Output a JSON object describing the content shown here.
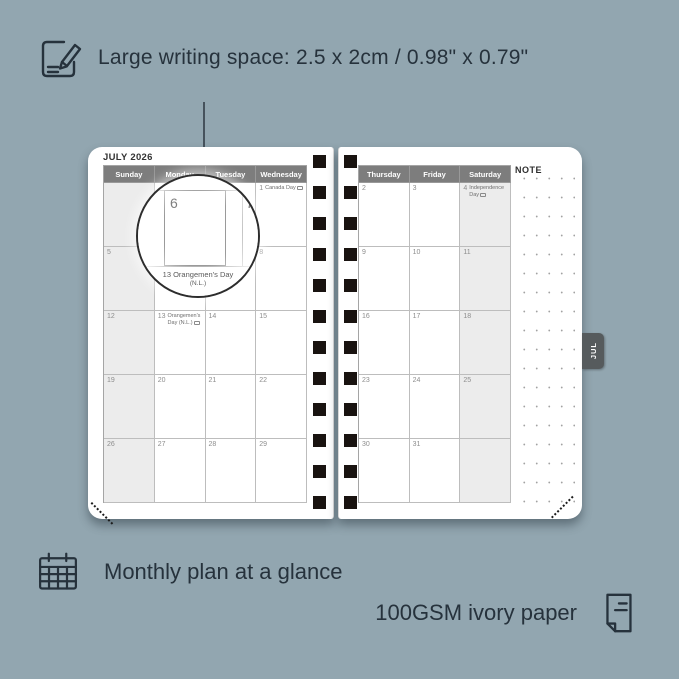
{
  "colors": {
    "background": "#92a6b0",
    "ink": "#26323c",
    "page": "#ffffff",
    "header_bg": "#7d7d7d",
    "header_text": "#ffffff",
    "weekend_fill": "#ececec",
    "grid_line": "#bdbdbd",
    "day_number": "#8d8d8d",
    "tab_bg": "#565b5d",
    "spiral_hole": "#191310"
  },
  "callouts": {
    "writing_space": {
      "label": "Large writing space: 2.5 x 2cm / 0.98\" x 0.79\"",
      "icon": "pencil-note-icon"
    },
    "monthly_plan": {
      "label": "Monthly plan at a glance",
      "icon": "calendar-grid-icon"
    },
    "paper": {
      "label": "100GSM ivory paper",
      "icon": "paper-sheet-icon"
    }
  },
  "planner": {
    "month_title": "JULY 2026",
    "tab_label": "JUL",
    "left_page": {
      "day_headers": [
        "Sunday",
        "Monday",
        "Tuesday",
        "Wednesday"
      ],
      "weekend_column": 0,
      "weeks": [
        [
          {
            "day": ""
          },
          {
            "day": ""
          },
          {
            "day": ""
          },
          {
            "day": "1",
            "label": "Canada Day",
            "badge": true
          }
        ],
        [
          {
            "day": "5"
          },
          {
            "day": "6"
          },
          {
            "day": "7"
          },
          {
            "day": "8"
          }
        ],
        [
          {
            "day": "12"
          },
          {
            "day": "13",
            "label": "Orangemen's Day (N.L.)",
            "badge": true
          },
          {
            "day": "14"
          },
          {
            "day": "15"
          }
        ],
        [
          {
            "day": "19"
          },
          {
            "day": "20"
          },
          {
            "day": "21"
          },
          {
            "day": "22"
          }
        ],
        [
          {
            "day": "26"
          },
          {
            "day": "27"
          },
          {
            "day": "28"
          },
          {
            "day": "29"
          }
        ]
      ]
    },
    "right_page": {
      "day_headers": [
        "Thursday",
        "Friday",
        "Saturday"
      ],
      "weekend_column": 2,
      "note_label": "NOTE",
      "weeks": [
        [
          {
            "day": "2"
          },
          {
            "day": "3"
          },
          {
            "day": "4",
            "label": "Independence Day",
            "badge": true
          }
        ],
        [
          {
            "day": "9"
          },
          {
            "day": "10"
          },
          {
            "day": "11"
          }
        ],
        [
          {
            "day": "16"
          },
          {
            "day": "17"
          },
          {
            "day": "18"
          }
        ],
        [
          {
            "day": "23"
          },
          {
            "day": "24"
          },
          {
            "day": "25"
          }
        ],
        [
          {
            "day": "30"
          },
          {
            "day": "31"
          },
          {
            "day": ""
          }
        ]
      ]
    },
    "magnifier": {
      "day_left": "6",
      "day_right": "7",
      "caption_line1": "13  Orangemen's Day",
      "caption_line2": "(N.L.)"
    }
  }
}
